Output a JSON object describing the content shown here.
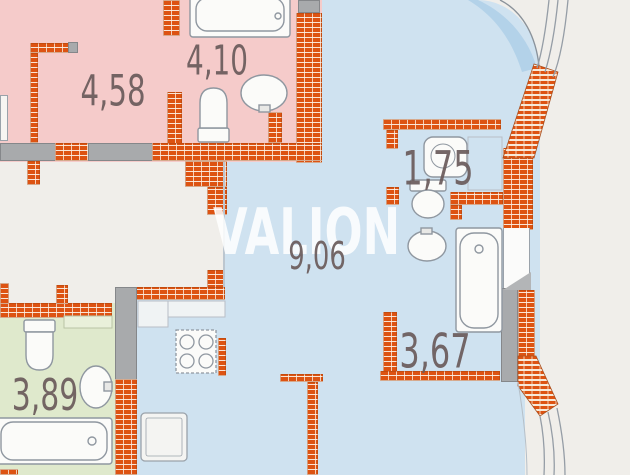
{
  "title": "apartment-floor-plan",
  "watermark": "VALION",
  "rooms": {
    "r458": {
      "label": "4,58",
      "type": "room",
      "fill": "#f5cbca"
    },
    "r410": {
      "label": "4,10",
      "type": "bathroom",
      "fill": "#f5cbca"
    },
    "r175": {
      "label": "1,75",
      "type": "wc",
      "fill": "#cfe2f0"
    },
    "r906": {
      "label": "9,06",
      "type": "kitchen-living",
      "fill": "#cfe2f0"
    },
    "r367": {
      "label": "3,67",
      "type": "bathroom",
      "fill": "#cfe2f0"
    },
    "r389": {
      "label": "3,89",
      "type": "bathroom",
      "fill": "#dfe9cc"
    }
  },
  "fixtures": [
    "bathtub",
    "toilet",
    "washbasin",
    "stove",
    "fridge",
    "counter",
    "window",
    "door"
  ],
  "colors": {
    "pink_room": "#f5cbca",
    "blue_room": "#cfe2f0",
    "blue_glazing": "#aecfe8",
    "green_room": "#dfe9cc",
    "corridor_white": "#f0eeea",
    "brick_wall": "#dd5312",
    "brick_mortar": "#f7e9d8",
    "gray_wall": "#a8aaac",
    "label_text": "#6b5c5c",
    "watermark_text": "#ffffff"
  }
}
